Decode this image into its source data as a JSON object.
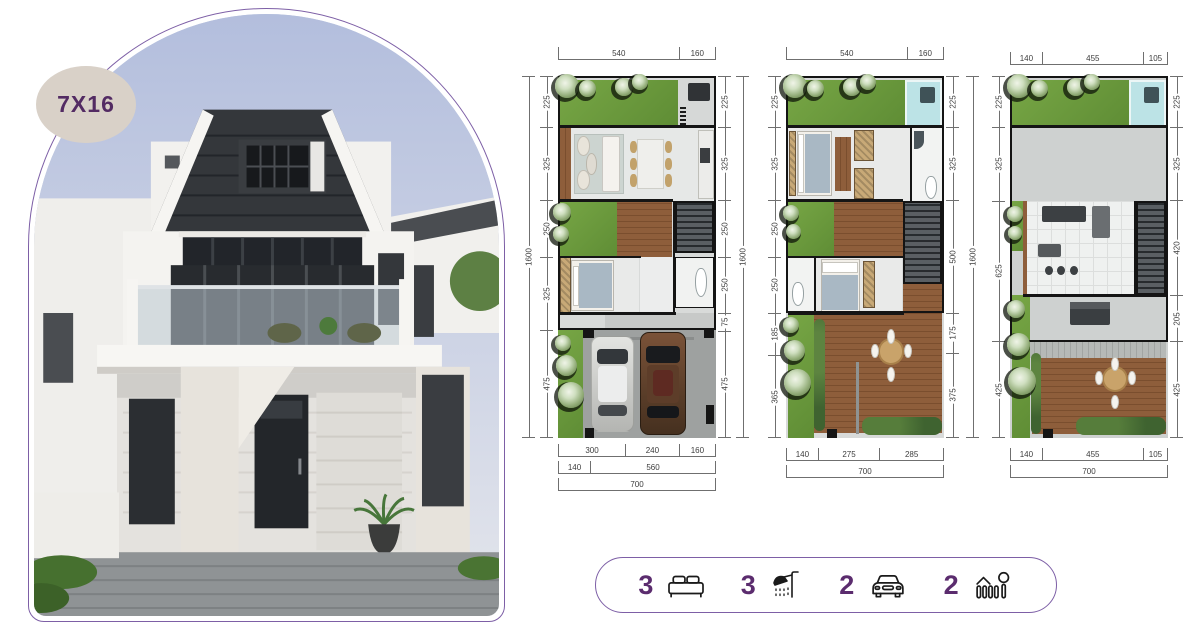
{
  "badge": {
    "label": "7X16"
  },
  "accent": {
    "purple": "#5b2c6e",
    "border_purple": "#7d5fa6",
    "badge_bg": "#d9d1c8"
  },
  "plans": [
    {
      "name": "ground-floor-plan",
      "top_dims": [
        "540",
        "160"
      ],
      "left_overall": "1600",
      "right_overall": "1600",
      "left_dims": [
        "225",
        "325",
        "250",
        "325",
        "475"
      ],
      "right_dims": [
        "225",
        "325",
        "250",
        "250",
        "75",
        "475"
      ],
      "bottom_rows": [
        [
          "300",
          "240",
          "160"
        ],
        [
          "140",
          "560"
        ],
        [
          "700"
        ]
      ]
    },
    {
      "name": "second-floor-plan",
      "top_dims": [
        "540",
        "160"
      ],
      "left_dims": [
        "225",
        "325",
        "250",
        "250",
        "185",
        "365"
      ],
      "right_dims": [
        "225",
        "325",
        "500",
        "175",
        "375"
      ],
      "right_overall": "1600",
      "bottom_rows": [
        [
          "140",
          "275",
          "285"
        ],
        [
          "700"
        ]
      ]
    },
    {
      "name": "rooftop-floor-plan",
      "top_dims": [
        "140",
        "455",
        "105"
      ],
      "left_dims": [
        "225",
        "325",
        "625",
        "425"
      ],
      "right_dims": [
        "225",
        "325",
        "420",
        "205",
        "425"
      ],
      "bottom_rows": [
        [
          "140",
          "455",
          "105"
        ],
        [
          "700"
        ]
      ]
    }
  ],
  "features": [
    {
      "label": "3",
      "icon": "bed-icon"
    },
    {
      "label": "3",
      "icon": "shower-icon"
    },
    {
      "label": "2",
      "icon": "car-icon"
    },
    {
      "label": "2",
      "icon": "garden-icon"
    }
  ]
}
